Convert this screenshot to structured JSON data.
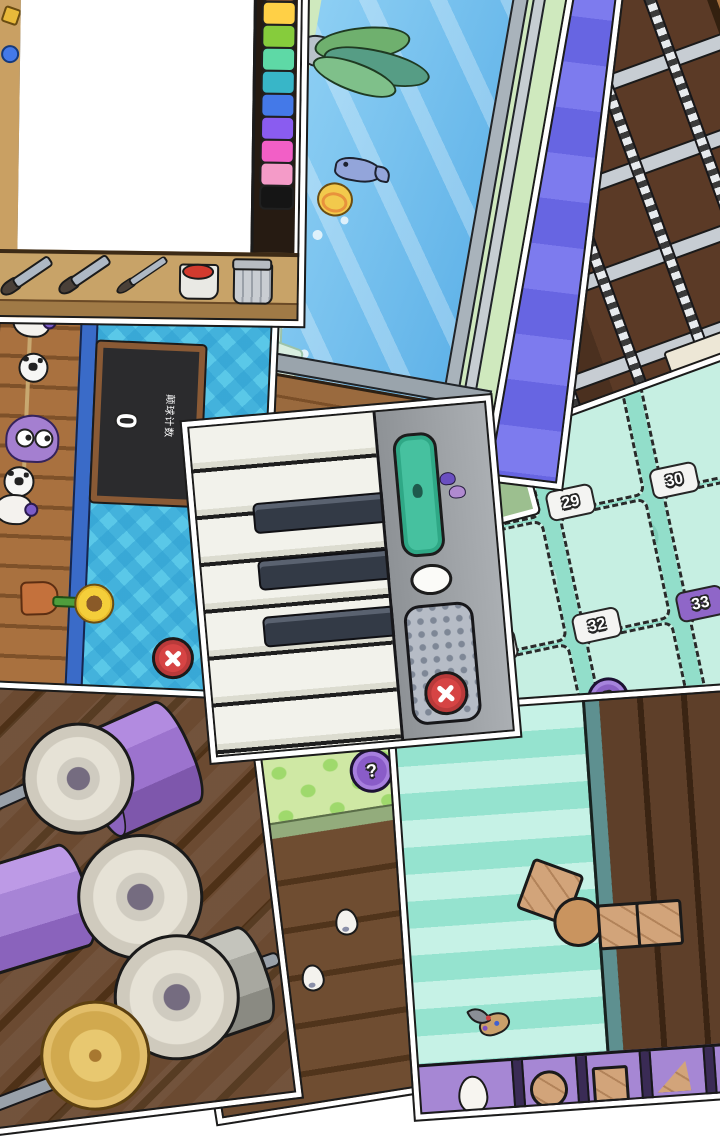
{
  "painting": {
    "palette_colors": [
      "#F0923E",
      "#7A4E32",
      "#FFD046",
      "#86CC3C",
      "#5ED9A6",
      "#38B6C8",
      "#4479E8",
      "#8A5CF0",
      "#F25FC6",
      "#F49BC8",
      "#151515"
    ],
    "tools": [
      "brush-large",
      "brush-medium",
      "brush-thin",
      "paint-bucket",
      "trash-can"
    ]
  },
  "guitar": {
    "chords": [
      "Am",
      "D",
      "G",
      ""
    ]
  },
  "soccer": {
    "score": "0",
    "score_label": "颠球计数"
  },
  "cards_game": {
    "slots": [
      {
        "number": "28",
        "badge": "white",
        "filled": true
      },
      {
        "number": "29",
        "badge": "white",
        "filled": false
      },
      {
        "number": "30",
        "badge": "white",
        "filled": false
      },
      {
        "number": "31",
        "badge": "white",
        "filled": false
      },
      {
        "number": "32",
        "badge": "white",
        "filled": false
      },
      {
        "number": "33",
        "badge": "purple",
        "filled": false
      },
      {
        "number": "34",
        "badge": "purple",
        "filled": false
      },
      {
        "number": "35",
        "badge": "purple",
        "filled": false
      },
      {
        "number": "36",
        "badge": "yellow",
        "filled": false
      }
    ],
    "deck_count": "2",
    "pagination": {
      "total": 7,
      "active_index": 3
    }
  },
  "polka": {
    "help_label": "?",
    "counter": "2"
  },
  "building": {
    "tray_shapes": [
      "egg",
      "circle",
      "square",
      "triangle",
      "egg"
    ]
  },
  "colors": {
    "close_button": "#D64444",
    "chord_button": "#8D5CC7",
    "purple_badge": "#8F66C8",
    "yellow_badge": "#E8C84A",
    "mint_bg": "#92DECA",
    "stripe_light": "#7D7BEE",
    "stripe_dark": "#6765E2"
  }
}
